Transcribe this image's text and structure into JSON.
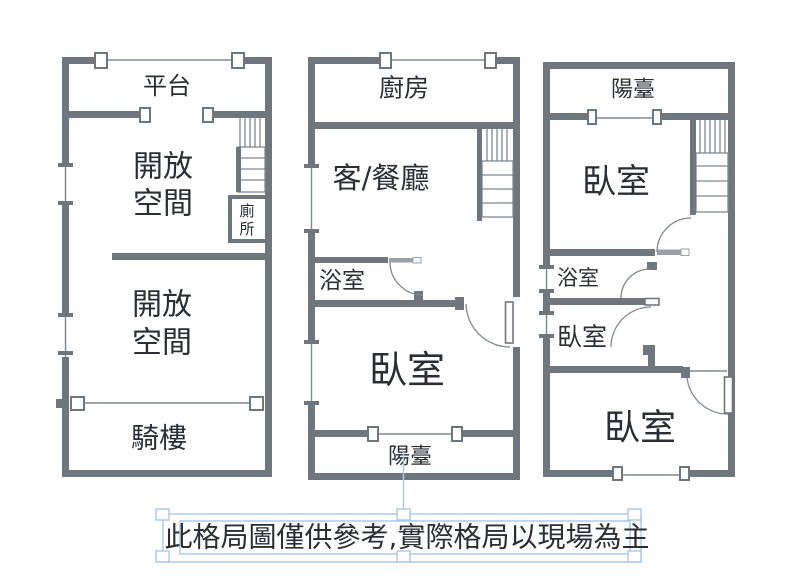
{
  "colors": {
    "wall": "#6f777e",
    "thin": "#80888f",
    "door": "#9aa2a9",
    "ink": "#2b2e33",
    "selection": "#a9c7e9"
  },
  "floor1": {
    "platform": "平台",
    "open_space_1_line1": "開放",
    "open_space_1_line2": "空間",
    "open_space_2_line1": "開放",
    "open_space_2_line2": "空間",
    "arcade": "騎樓",
    "toilet_line1": "廁",
    "toilet_line2": "所"
  },
  "floor2": {
    "kitchen": "廚房",
    "living_dining": "客/餐廳",
    "bathroom": "浴室",
    "bedroom": "臥室",
    "balcony": "陽臺"
  },
  "floor3": {
    "balcony": "陽臺",
    "bedroom_top": "臥室",
    "bathroom": "浴室",
    "bedroom_middle": "臥室",
    "bedroom_bottom": "臥室"
  },
  "disclaimer": {
    "text": "此格局圖僅供參考,實際格局以現場為主"
  }
}
